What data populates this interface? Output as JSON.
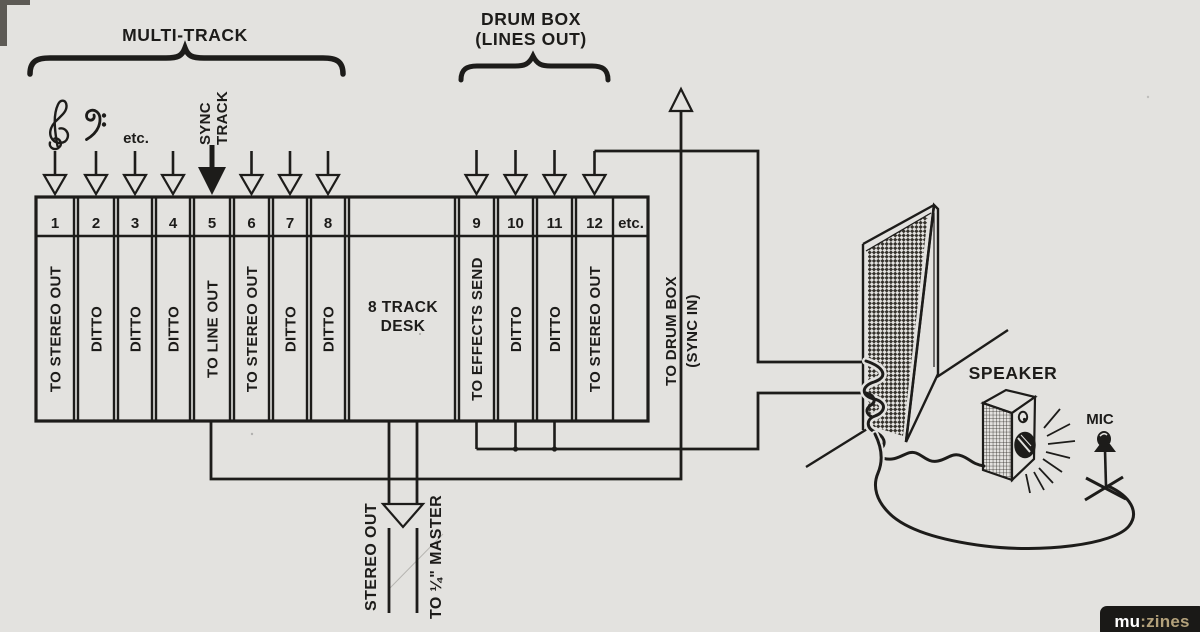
{
  "colors": {
    "paper": "#e3e2df",
    "ink": "#1d1c1a",
    "logo_bg": "#1a1917",
    "logo_mu": "#ffffff",
    "logo_zines": "#b3a17b"
  },
  "top": {
    "multitrack_label": "MULTI-TRACK",
    "drumbox_label_line1": "DRUM BOX",
    "drumbox_label_line2": "(LINES OUT)",
    "clefs_etc": "etc.",
    "sync_track_line1": "SYNC",
    "sync_track_line2": "TRACK"
  },
  "desk": {
    "title_line1": "8 TRACK",
    "title_line2": "DESK",
    "header_etc": "etc.",
    "channels": [
      {
        "num": "1",
        "label": "TO STEREO OUT"
      },
      {
        "num": "2",
        "label": "DITTO"
      },
      {
        "num": "3",
        "label": "DITTO"
      },
      {
        "num": "4",
        "label": "DITTO"
      },
      {
        "num": "5",
        "label": "TO LINE OUT"
      },
      {
        "num": "6",
        "label": "TO STEREO OUT"
      },
      {
        "num": "7",
        "label": "DITTO"
      },
      {
        "num": "8",
        "label": "DITTO"
      },
      {
        "num": "9",
        "label": "TO EFFECTS SEND"
      },
      {
        "num": "10",
        "label": "DITTO"
      },
      {
        "num": "11",
        "label": "DITTO"
      },
      {
        "num": "12",
        "label": "TO STEREO OUT"
      }
    ]
  },
  "routing": {
    "drum_sync_line1": "TO DRUM BOX",
    "drum_sync_line2": "(SYNC IN)",
    "stereo_out_label": "STEREO OUT",
    "master_label": "TO ¼\" MASTER"
  },
  "room": {
    "speaker_label": "SPEAKER",
    "mic_label": "MIC"
  },
  "logo": {
    "prefix": "mu",
    "suffix": ":zines"
  }
}
